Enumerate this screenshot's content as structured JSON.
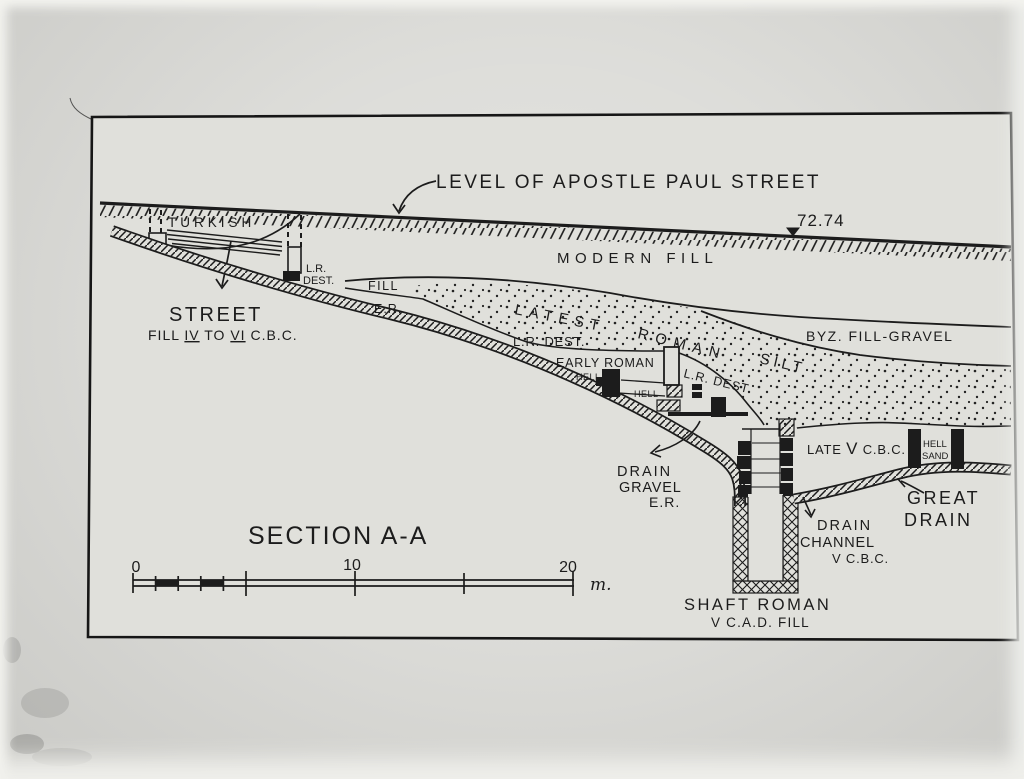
{
  "section_title": "SECTION A-A",
  "street_level": {
    "label": "LEVEL OF APOSTLE PAUL STREET",
    "elevation": "72.74"
  },
  "layers": {
    "modern_fill": "MODERN FILL",
    "turkish": "TURKISH",
    "lr_dest_turkish_line1": "L.R.",
    "lr_dest_turkish_line2": "DEST.",
    "fill_upper": "FILL",
    "er_upper": "E.R.",
    "latest": "LATEST",
    "roman": "ROMAN",
    "silt": "SILT",
    "byz_fill_gravel": "BYZ. FILL-GRAVEL",
    "lr_dest_mid": "L.R. DEST.",
    "early_roman": "EARLY ROMAN",
    "hell_a": "HELL",
    "hell_b": "HELL",
    "lr_dest_right": "L.R. DEST",
    "late_v": {
      "p1": "LATE ",
      "p2": "V",
      "p3": " C.B.C."
    },
    "hell_sand_line1": "HELL",
    "hell_sand_line2": "SAND"
  },
  "street_fill": {
    "heading": "STREET",
    "p1": "FILL ",
    "n1": "IV",
    "p2": " TO ",
    "n2": "VI",
    "p3": " C.B.C."
  },
  "annotations": {
    "drain_gravel_line1": "DRAIN",
    "drain_gravel_line2": "GRAVEL",
    "drain_gravel_line3": "E.R.",
    "great_drain_line1": "GREAT",
    "great_drain_line2": "DRAIN",
    "drain_channel_line1": "DRAIN",
    "drain_channel_line2": "CHANNEL",
    "drain_channel_line3": "V C.B.C.",
    "shaft_line1": "SHAFT ROMAN",
    "shaft_line2": "V C.A.D. FILL"
  },
  "scale": {
    "tick0": "0",
    "tick10": "10",
    "tick20": "20",
    "unit": "m."
  },
  "colors": {
    "ink": "#1c1c1c",
    "paper": "#e0e0db",
    "surround": "#d6d6d2"
  }
}
